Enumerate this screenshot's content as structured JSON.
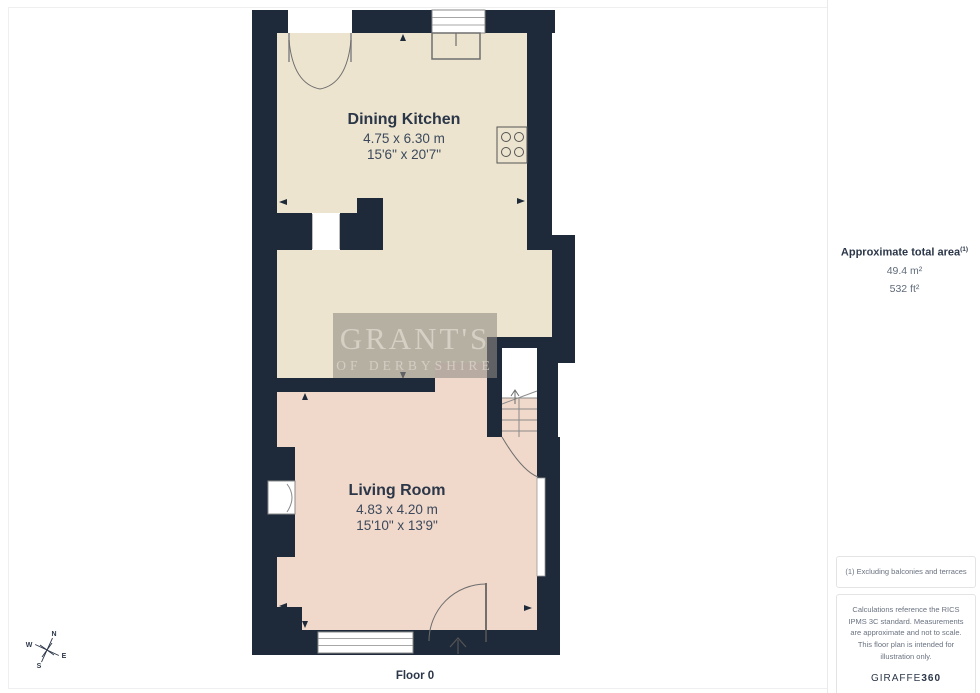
{
  "rooms": [
    {
      "name": "Dining Kitchen",
      "dims_m": "4.75 x 6.30 m",
      "dims_ft": "15'6\" x 20'7\""
    },
    {
      "name": "Living Room",
      "dims_m": "4.83 x 4.20 m",
      "dims_ft": "15'10\" x 13'9\""
    }
  ],
  "watermark": {
    "line1": "GRANT'S",
    "line2": "OF DERBYSHIRE"
  },
  "sidebar": {
    "area_title": "Approximate total area",
    "area_superscript": "(1)",
    "area_m2": "49.4 m²",
    "area_ft2": "532 ft²"
  },
  "footnotes": {
    "note1": "(1) Excluding balconies and terraces",
    "disclaimer": "Calculations reference the RICS IPMS 3C standard. Measurements are approximate and not to scale. This floor plan is intended for illustration only.",
    "brand_regular": "GIRAFFE",
    "brand_bold": "360"
  },
  "floor_label": "Floor 0",
  "compass": {
    "n": "N",
    "e": "E",
    "s": "S",
    "w": "W"
  },
  "colors": {
    "wall": "#1e2a39",
    "kitchen_floor": "#ece4ce",
    "living_floor": "#f0d8ca"
  }
}
